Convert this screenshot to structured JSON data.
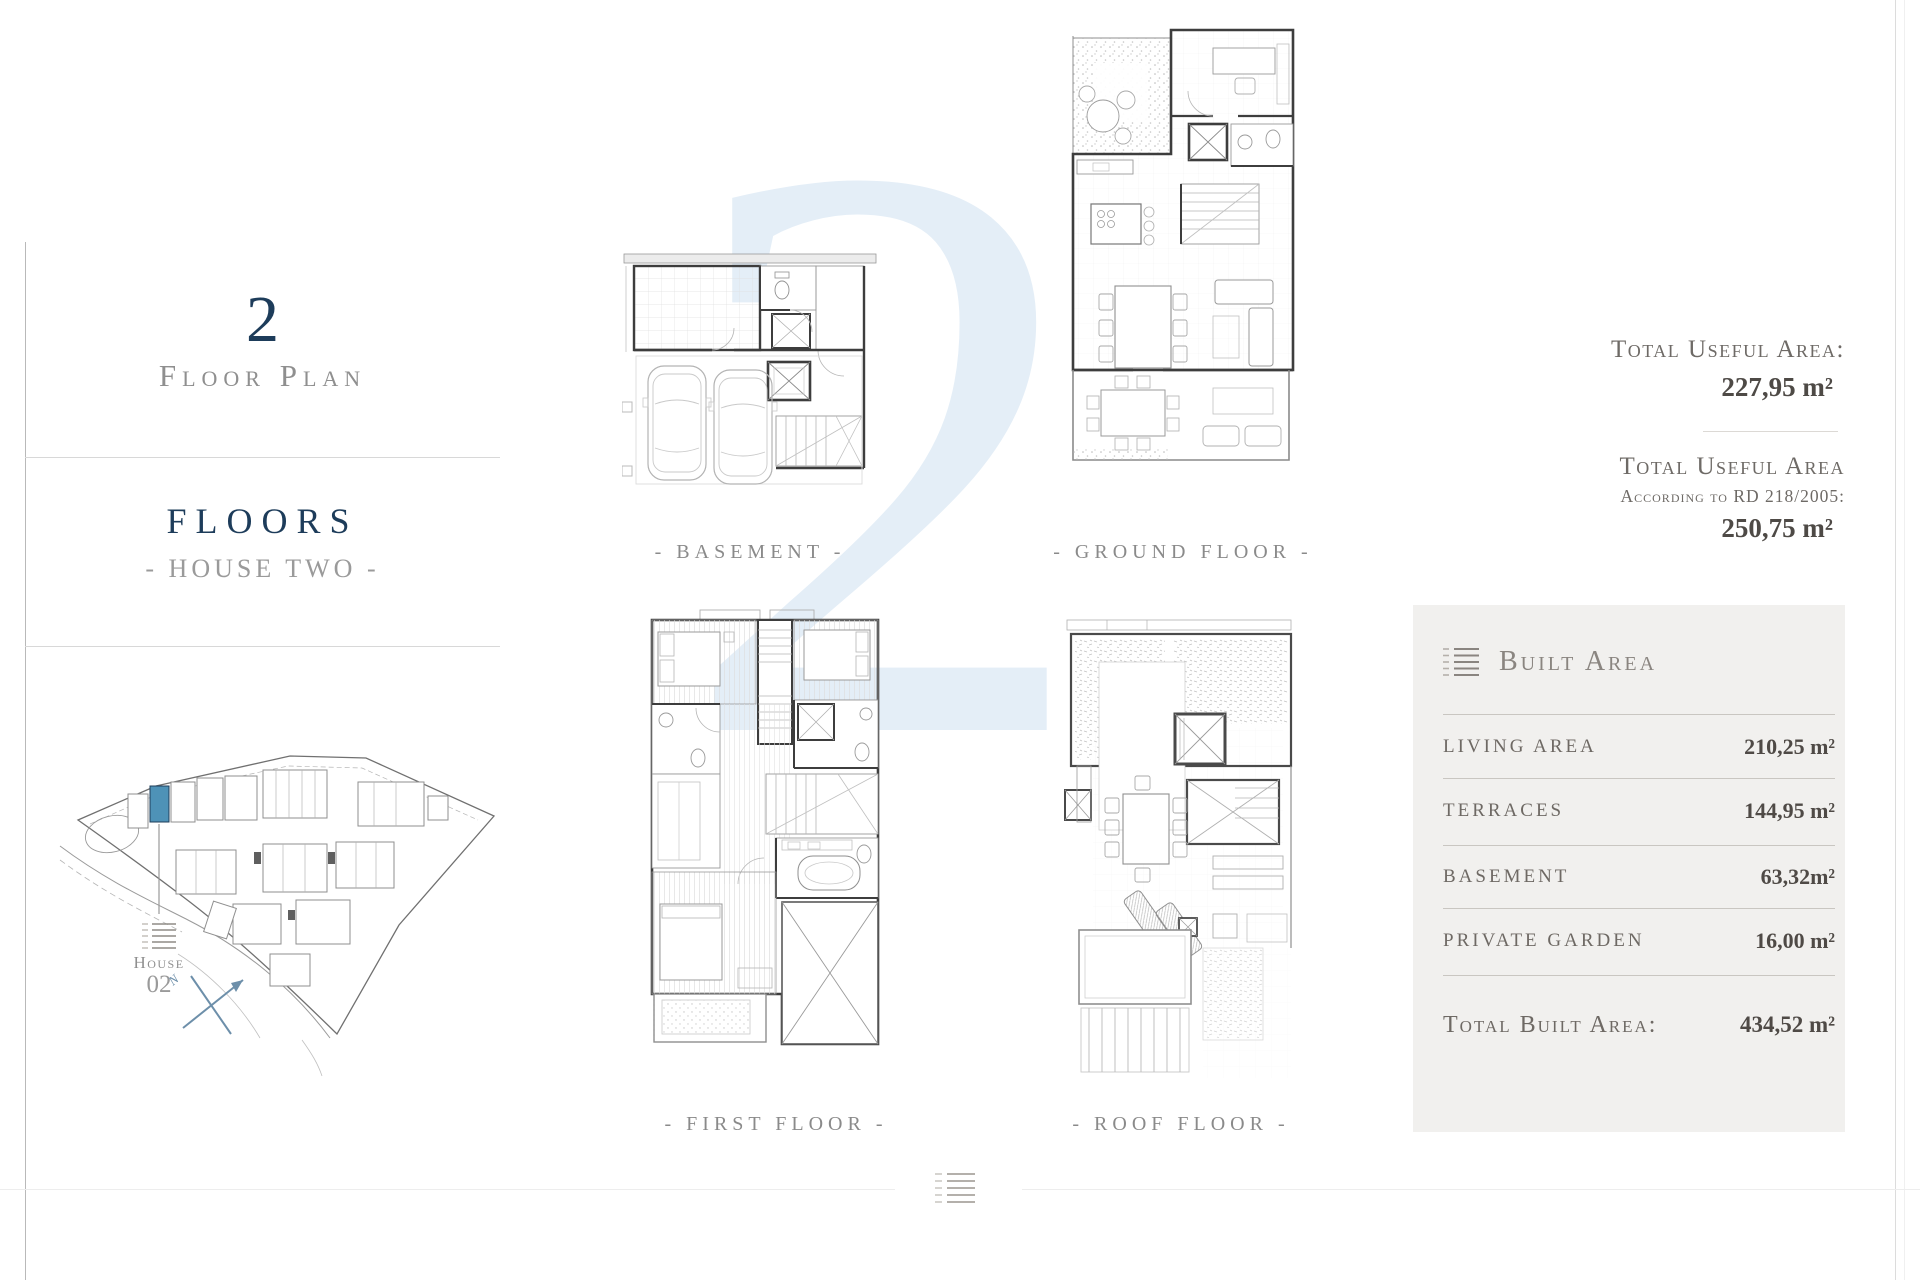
{
  "left_panel": {
    "plan_number": "2",
    "plan_label": "Floor Plan",
    "section_title": "FLOORS",
    "section_subtitle": "- HOUSE TWO -",
    "site_map": {
      "house_label_line1": "House",
      "house_label_line2": "02",
      "north_label": "N",
      "highlight_color": "#4e92b7"
    }
  },
  "plans": {
    "basement": {
      "label": "- BASEMENT -"
    },
    "ground": {
      "label": "- GROUND FLOOR -"
    },
    "first": {
      "label": "- FIRST FLOOR -"
    },
    "roof": {
      "label": "- ROOF FLOOR -"
    }
  },
  "useful_area": {
    "title1": "Total Useful Area:",
    "value1": "227,95  m²",
    "title2_line1": "Total Useful Area",
    "title2_line2": "According to RD 218/2005:",
    "value2": "250,75  m²"
  },
  "built_area": {
    "icon": "list-lines-icon",
    "title": "Built Area",
    "rows": [
      {
        "label": "LIVING AREA",
        "value": "210,25 m²"
      },
      {
        "label": "TERRACES",
        "value": "144,95 m²"
      },
      {
        "label": "BASEMENT",
        "value": "63,32m²"
      },
      {
        "label": "PRIVATE GARDEN",
        "value": "16,00 m²"
      }
    ],
    "total": {
      "label": "Total Built Area:",
      "value": "434,52 m²"
    }
  },
  "watermark": "2",
  "colors": {
    "accent_navy": "#1d3c5a",
    "highlight_blue": "#4e92b7",
    "watermark_blue": "#e4eef7",
    "panel_bg": "#f1f0ee"
  }
}
